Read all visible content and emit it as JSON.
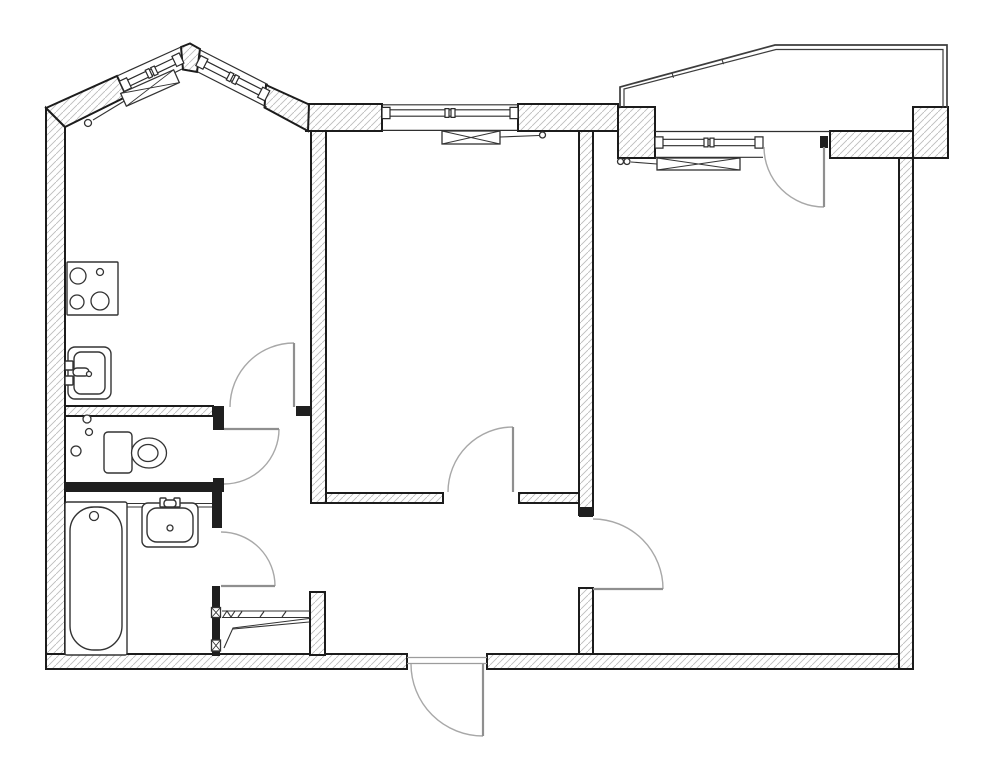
{
  "title": "two-room-apartment-floor-plan",
  "canvas": {
    "width": 1001,
    "height": 768,
    "background": "#ffffff"
  },
  "colors": {
    "background": "#ffffff",
    "wall_outline": "#1c1c1c",
    "wall_hatch": "#bdbdbd",
    "wall_solid": "#1f1f1f",
    "thin_line": "#2f2f2f",
    "window_line": "#2b2b2b",
    "fixture_line": "#333333",
    "door_leaf": "#8f8f8f",
    "door_arc": "#a8a8a8",
    "balcony_line": "#3d3d3d",
    "threshold": "#9c9c9c"
  },
  "floor_plan": {
    "walls_hatched": [
      {
        "name": "wall-left",
        "points": [
          [
            46,
            108
          ],
          [
            65,
            127
          ],
          [
            65,
            669
          ],
          [
            46,
            669
          ]
        ]
      },
      {
        "name": "wall-bottom-left",
        "points": [
          [
            46,
            654
          ],
          [
            407,
            654
          ],
          [
            407,
            669
          ],
          [
            46,
            669
          ]
        ]
      },
      {
        "name": "wall-bottom-right",
        "points": [
          [
            487,
            654
          ],
          [
            913,
            654
          ],
          [
            913,
            669
          ],
          [
            487,
            669
          ]
        ]
      },
      {
        "name": "wall-right",
        "points": [
          [
            899,
            158
          ],
          [
            913,
            158
          ],
          [
            913,
            669
          ],
          [
            899,
            669
          ]
        ]
      },
      {
        "name": "wall-top-right-corner-block",
        "points": [
          [
            913,
            107
          ],
          [
            948,
            107
          ],
          [
            948,
            158
          ],
          [
            913,
            158
          ]
        ]
      },
      {
        "name": "wall-top-right-b",
        "points": [
          [
            830,
            131
          ],
          [
            913,
            131
          ],
          [
            913,
            158
          ],
          [
            830,
            158
          ]
        ]
      },
      {
        "name": "wall-top-right-a",
        "points": [
          [
            618,
            107
          ],
          [
            655,
            107
          ],
          [
            655,
            158
          ],
          [
            618,
            158
          ]
        ]
      },
      {
        "name": "wall-top-mid-right",
        "points": [
          [
            518,
            104
          ],
          [
            618,
            104
          ],
          [
            618,
            131
          ],
          [
            518,
            131
          ]
        ]
      },
      {
        "name": "wall-top-mid-left",
        "points": [
          [
            306,
            104
          ],
          [
            382,
            104
          ],
          [
            382,
            131
          ],
          [
            306,
            131
          ]
        ]
      },
      {
        "name": "wall-bay-left",
        "points": [
          [
            46,
            108
          ],
          [
            117,
            76
          ],
          [
            126.5,
            96.5
          ],
          [
            65,
            127
          ]
        ]
      },
      {
        "name": "wall-bay-apex",
        "points": [
          [
            181,
            47
          ],
          [
            190,
            43.5
          ],
          [
            200,
            49
          ],
          [
            197,
            72
          ],
          [
            183,
            69.5
          ]
        ]
      },
      {
        "name": "wall-bay-right",
        "points": [
          [
            266,
            85
          ],
          [
            309,
            104.5
          ],
          [
            308,
            131
          ],
          [
            264.5,
            107.5
          ]
        ]
      },
      {
        "name": "wall-kitchen-livingroom",
        "points": [
          [
            311,
            131
          ],
          [
            326,
            131
          ],
          [
            326,
            503
          ],
          [
            311,
            503
          ]
        ]
      },
      {
        "name": "wall-closet-right",
        "points": [
          [
            310,
            592
          ],
          [
            325,
            592
          ],
          [
            325,
            655
          ],
          [
            310,
            655
          ]
        ]
      },
      {
        "name": "wall-hall-bedroom-upper",
        "points": [
          [
            579,
            131
          ],
          [
            593,
            131
          ],
          [
            593,
            515
          ],
          [
            579,
            515
          ]
        ]
      },
      {
        "name": "wall-hall-bedroom-lower",
        "points": [
          [
            579,
            588
          ],
          [
            593,
            588
          ],
          [
            593,
            654
          ],
          [
            579,
            654
          ]
        ]
      },
      {
        "name": "wall-kitchen-bottom",
        "points": [
          [
            65,
            406
          ],
          [
            213,
            406
          ],
          [
            213,
            416
          ],
          [
            65,
            416
          ]
        ]
      },
      {
        "name": "wall-livingroom-bottom-a",
        "points": [
          [
            326,
            493
          ],
          [
            443,
            493
          ],
          [
            443,
            503
          ],
          [
            326,
            503
          ]
        ]
      },
      {
        "name": "wall-livingroom-bottom-b",
        "points": [
          [
            519,
            493
          ],
          [
            579,
            493
          ],
          [
            579,
            503
          ],
          [
            519,
            503
          ]
        ]
      }
    ],
    "walls_solid": [
      {
        "name": "jamb-toilet-top",
        "rect": [
          213,
          406,
          11,
          24
        ]
      },
      {
        "name": "jamb-toilet-bottom",
        "rect": [
          213,
          478,
          11,
          14
        ]
      },
      {
        "name": "wall-toilet-bath-divider",
        "rect": [
          65,
          482,
          159,
          10
        ]
      },
      {
        "name": "wall-bath-right-top",
        "rect": [
          212,
          492,
          10,
          36
        ]
      },
      {
        "name": "wall-bath-right-bottom",
        "rect": [
          212,
          586,
          8,
          70
        ]
      },
      {
        "name": "jamb-kitchen-door",
        "rect": [
          296,
          406,
          15,
          10
        ]
      },
      {
        "name": "jamb-bedroom-door",
        "rect": [
          579,
          507,
          14,
          10
        ]
      },
      {
        "name": "post-balcony-door",
        "rect": [
          820,
          136,
          8,
          12
        ]
      }
    ],
    "thin_lines": [
      {
        "name": "face-line-living-window-outer",
        "pts": [
          382,
          104.8,
          518,
          104.8
        ]
      },
      {
        "name": "face-line-living-window-inner",
        "pts": [
          382,
          130.4,
          518,
          130.4
        ]
      },
      {
        "name": "balcony-floor-line",
        "pts": [
          655,
          131.5,
          830,
          131.5
        ]
      },
      {
        "name": "face-line-bedroom-window-inner",
        "pts": [
          655,
          157.3,
          763,
          157.3
        ]
      },
      {
        "name": "face-line-bay-left-outer",
        "pts": [
          117,
          76,
          181,
          47
        ]
      },
      {
        "name": "face-line-bay-left-inner",
        "pts": [
          126.5,
          96.5,
          182,
          69
        ]
      },
      {
        "name": "face-line-bay-right-outer",
        "pts": [
          199,
          49.4,
          268,
          84.6
        ]
      },
      {
        "name": "face-line-bay-right-inner",
        "pts": [
          197.6,
          71.9,
          266.6,
          107
        ]
      },
      {
        "name": "entrance-threshold-outer",
        "pts": [
          407,
          657.5,
          487,
          657.5
        ],
        "color": "#9c9c9c"
      },
      {
        "name": "entrance-threshold-inner",
        "pts": [
          407,
          663.5,
          487,
          663.5
        ],
        "color": "#9c9c9c"
      }
    ],
    "windows": [
      {
        "name": "kitchen-bay-window-left",
        "a": [
          121.8,
          86.3
        ],
        "b": [
          181.5,
          58
        ],
        "fhw": 3.2,
        "phw": 5.6,
        "plen": 8,
        "mull": true
      },
      {
        "name": "kitchen-bay-window-right",
        "a": [
          198.3,
          60.6
        ],
        "b": [
          267.3,
          95.8
        ],
        "fhw": 3.2,
        "phw": 5.6,
        "plen": 8,
        "mull": true
      },
      {
        "name": "livingroom-window",
        "a": [
          382,
          113
        ],
        "b": [
          518,
          113
        ],
        "fhw": 3.2,
        "phw": 5.6,
        "plen": 8,
        "mull": true
      },
      {
        "name": "bedroom-window",
        "a": [
          655,
          142.5
        ],
        "b": [
          763,
          142.5
        ],
        "fhw": 3.2,
        "phw": 5.6,
        "plen": 8,
        "mull": true
      }
    ],
    "doors": [
      {
        "name": "kitchen-door",
        "leaf": [
          294,
          343,
          294,
          407
        ],
        "arc": "M230,407 A64,64 0 0 1 294,343"
      },
      {
        "name": "toilet-door",
        "leaf": [
          224,
          429,
          279,
          429
        ],
        "arc": "M279,429 A55,55 0 0 1 224,484"
      },
      {
        "name": "bathroom-door",
        "leaf": [
          221,
          586,
          275,
          586
        ],
        "arc": "M275,586 A54,54 0 0 0 221,532"
      },
      {
        "name": "livingroom-door",
        "leaf": [
          513,
          427,
          513,
          492
        ],
        "arc": "M513,427 A65,65 0 0 0 448,492"
      },
      {
        "name": "bedroom-door",
        "leaf": [
          593,
          589,
          663,
          589
        ],
        "arc": "M593,519 A70,70 0 0 1 663,589"
      },
      {
        "name": "balcony-door",
        "leaf": [
          824,
          147,
          824,
          207
        ],
        "arc": "M764,147 A60,60 0 0 0 824,207"
      },
      {
        "name": "entrance-door",
        "leaf": [
          483,
          664,
          483,
          736
        ],
        "arc": "M411,664 A72,72 0 0 0 483,736"
      }
    ],
    "balcony": {
      "outer": [
        [
          620,
          107
        ],
        [
          620,
          87
        ],
        [
          775,
          45
        ],
        [
          947,
          45
        ],
        [
          947,
          108
        ]
      ],
      "inner": [
        [
          624,
          107
        ],
        [
          624,
          89
        ],
        [
          776,
          49.5
        ],
        [
          943,
          49.5
        ],
        [
          943,
          108
        ]
      ],
      "ticks": [
        [
          672,
          73,
          673.5,
          77.8
        ],
        [
          722,
          59.5,
          723.5,
          64.2
        ]
      ]
    },
    "fixtures": [
      {
        "name": "stove-icon",
        "prims": [
          [
            "r",
            67,
            262,
            51,
            53,
            1
          ],
          [
            "c",
            78,
            276,
            8
          ],
          [
            "c",
            100,
            272,
            3.5
          ],
          [
            "c",
            77,
            302,
            7
          ],
          [
            "c",
            100,
            301,
            9
          ]
        ]
      },
      {
        "name": "kitchen-sink-icon",
        "prims": [
          [
            "r",
            68,
            347,
            43,
            52,
            7
          ],
          [
            "r",
            74,
            352,
            31,
            42,
            7
          ],
          [
            "r",
            65,
            361,
            8,
            9,
            1
          ],
          [
            "r",
            65,
            376,
            8,
            9,
            1
          ],
          [
            "r",
            73,
            368,
            16,
            8,
            4
          ],
          [
            "c",
            89,
            374,
            2.5
          ]
        ]
      },
      {
        "name": "toilet-icon",
        "prims": [
          [
            "r",
            104,
            432,
            28,
            41,
            4
          ],
          [
            "e",
            149,
            453,
            17.5,
            15
          ],
          [
            "e",
            148,
            453,
            10,
            8.5
          ]
        ]
      },
      {
        "name": "pipe-risers-icon",
        "prims": [
          [
            "c",
            87,
            419,
            4
          ],
          [
            "c",
            89,
            432,
            3.5
          ],
          [
            "c",
            76,
            451,
            5
          ]
        ]
      },
      {
        "name": "bathtub-icon",
        "prims": [
          [
            "r",
            65,
            502,
            62,
            153,
            2
          ],
          [
            "r",
            70,
            507,
            52,
            143,
            24
          ],
          [
            "c",
            94,
            516,
            4.5
          ]
        ]
      },
      {
        "name": "washbasin-icon",
        "prims": [
          [
            "l",
            127,
            503.5,
            212,
            503.5
          ],
          [
            "l",
            127,
            507,
            212,
            507
          ],
          [
            "r",
            142,
            503,
            56,
            44,
            6
          ],
          [
            "r",
            147,
            508,
            46,
            34,
            10
          ],
          [
            "r",
            160,
            498,
            6,
            9,
            1
          ],
          [
            "r",
            174,
            498,
            6,
            9,
            1
          ],
          [
            "r",
            164,
            500,
            12,
            7,
            3
          ],
          [
            "c",
            170,
            528,
            3
          ]
        ]
      },
      {
        "name": "radiator-livingroom-icon",
        "prims": [
          [
            "l",
            500,
            137,
            539,
            135.5
          ],
          [
            "c",
            542.5,
            135,
            3
          ],
          [
            "x",
            471,
            137.5,
            58,
            13,
            0
          ]
        ]
      },
      {
        "name": "radiator-bedroom-icon",
        "prims": [
          [
            "l",
            631,
            162,
            657,
            164
          ],
          [
            "c",
            627,
            161.5,
            3
          ],
          [
            "c",
            620.5,
            161.5,
            3
          ],
          [
            "x",
            698.5,
            164,
            83,
            12,
            0
          ]
        ]
      },
      {
        "name": "radiator-kitchen-icon",
        "prims": [
          [
            "l",
            93,
            120,
            126,
            100
          ],
          [
            "c",
            88,
            123,
            3.5
          ],
          [
            "x",
            150,
            88,
            58,
            14,
            -24
          ]
        ]
      },
      {
        "name": "closet-shelves-icon",
        "prims": [
          [
            "l",
            222,
            611,
            310,
            611
          ],
          [
            "l",
            222,
            617.5,
            310,
            617.5
          ],
          [
            "l",
            238,
            617,
            242,
            611.5
          ],
          [
            "l",
            260,
            617,
            264,
            611.5
          ],
          [
            "l",
            282,
            617,
            286,
            611.5
          ],
          [
            "pl",
            [
              223,
              617,
              227,
              611,
              231,
              617,
              235,
              611
            ]
          ],
          [
            "pl",
            [
              224,
              648,
              233,
              628,
              309,
              618.5
            ]
          ],
          [
            "l",
            233,
            629,
            309,
            622
          ],
          [
            "x",
            216,
            612.5,
            9,
            10,
            0
          ],
          [
            "x",
            216,
            645.5,
            9,
            11,
            0
          ]
        ]
      }
    ]
  }
}
